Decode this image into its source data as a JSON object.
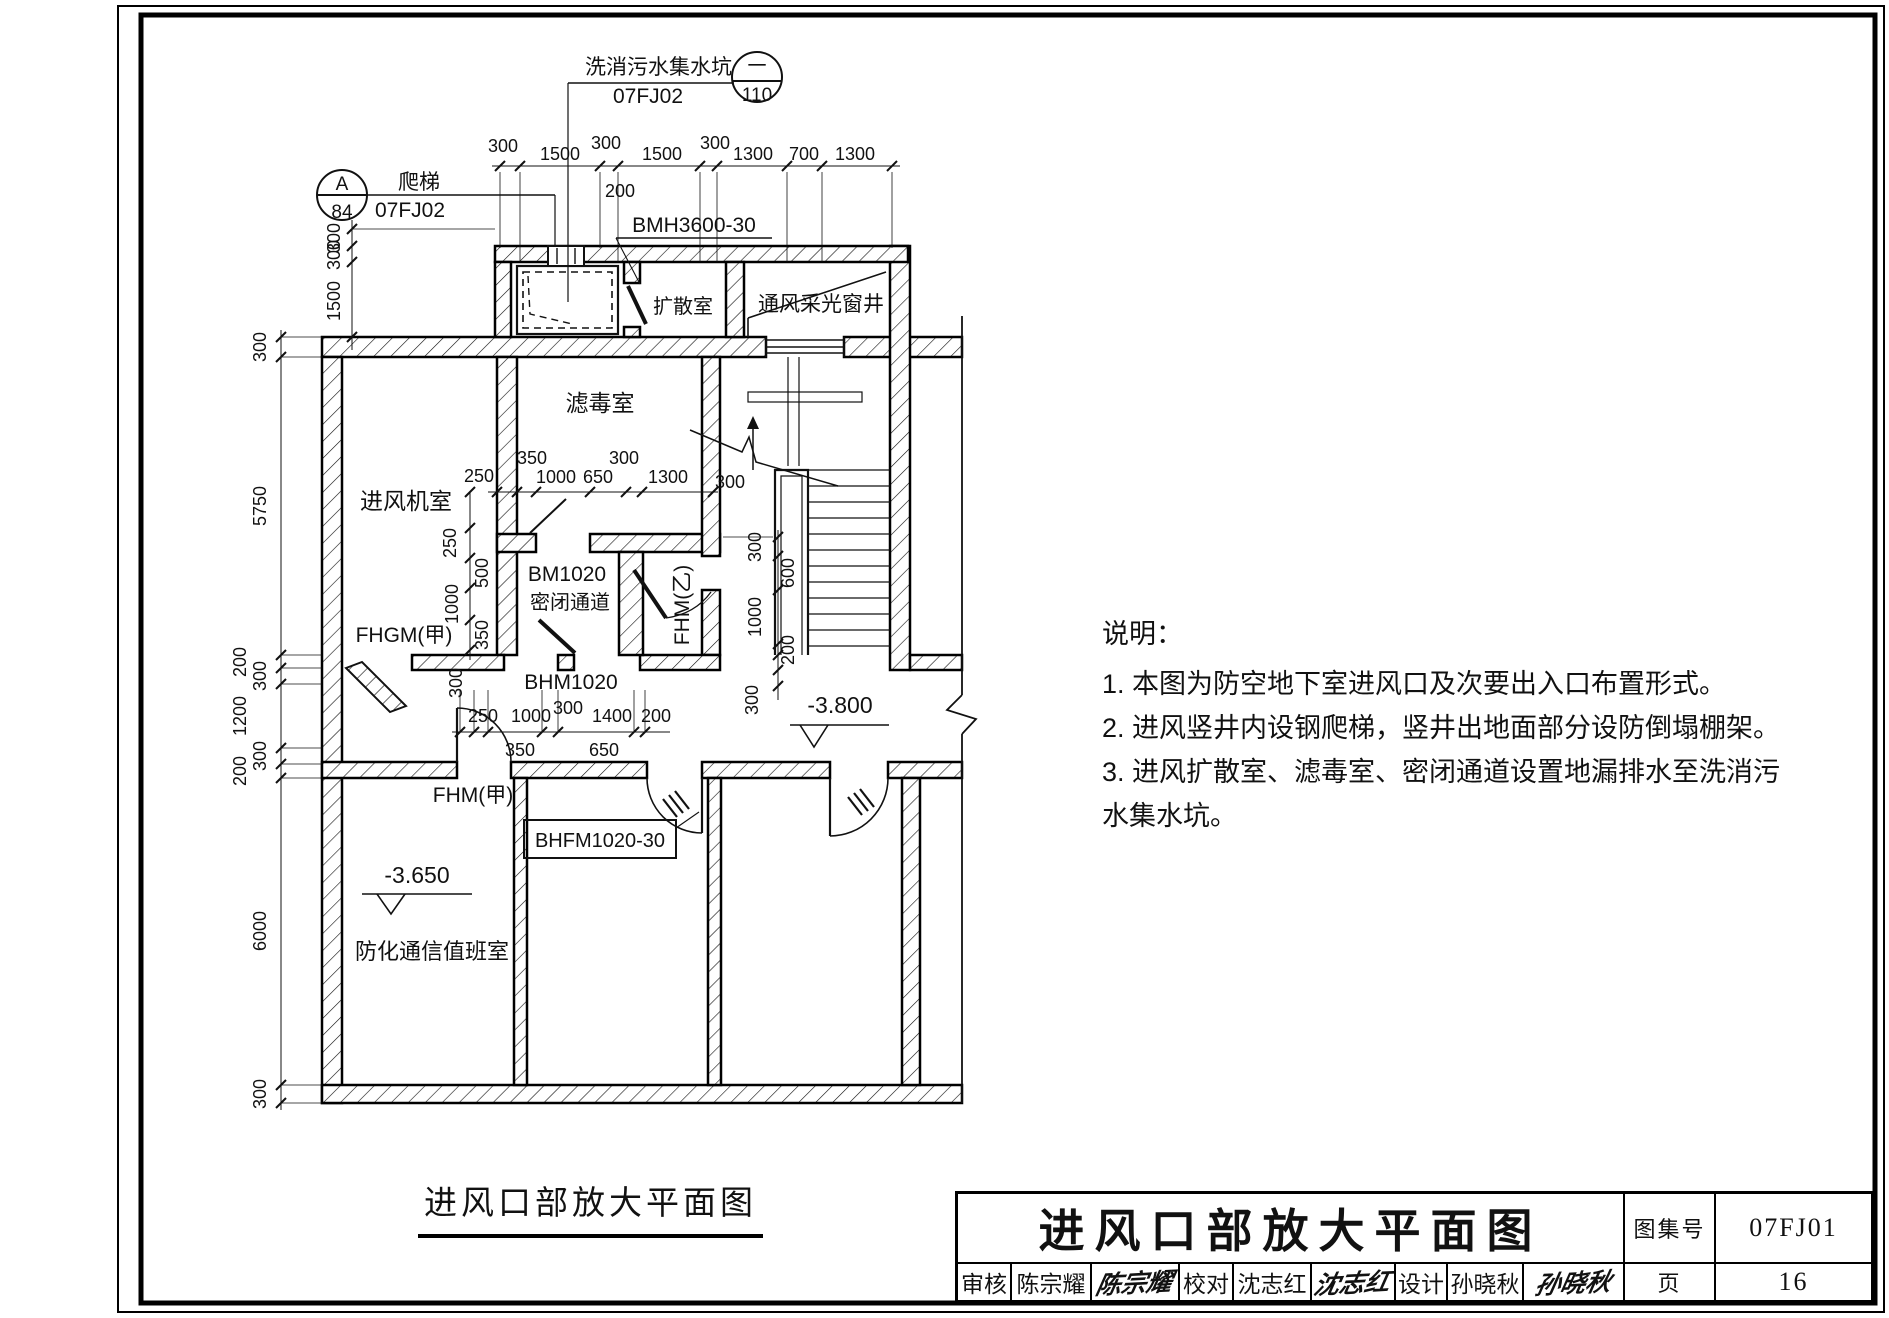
{
  "callouts": {
    "sump": {
      "name": "洗消污水集水坑",
      "ref": "07FJ02",
      "num": "一",
      "den": "110"
    },
    "ladder": {
      "name": "爬梯",
      "ref": "07FJ02",
      "num": "A",
      "den": "84"
    }
  },
  "rooms": {
    "fan_room": "进风机室",
    "filter_room": "滤毒室",
    "diffusion_room": "扩散室",
    "light_well": "通风采光窗井",
    "duty_room": "防化通信值班室",
    "passage": "密闭通道"
  },
  "doors": {
    "bmh": "BMH3600-30",
    "bm": "BM1020",
    "bhm": "BHM1020",
    "fhgm_a": "FHGM(甲)",
    "fhm_b": "FHM(乙)",
    "fhm_a": "FHM(甲)",
    "bhfm": "BHFM1020-30"
  },
  "levels": {
    "corridor": "-3.800",
    "room": "-3.650"
  },
  "dims": {
    "top": [
      "300",
      "1500",
      "300",
      "1500",
      "300",
      "1300",
      "700",
      "1300"
    ],
    "top_sub": "200",
    "shaft_left": [
      "300",
      "300",
      "1500"
    ],
    "left": [
      "300",
      "5750",
      "200",
      "300",
      "1200",
      "300",
      "200",
      "6000",
      "300"
    ],
    "filter": [
      "250",
      "350",
      "1000",
      "650",
      "300",
      "1300"
    ],
    "filter_wall": "300",
    "passage_v": [
      "250",
      "500",
      "1000",
      "350"
    ],
    "passage_wall": "300",
    "stair_v": [
      "300",
      "600",
      "1000",
      "200"
    ],
    "stair_wall": "300",
    "corridor": [
      "250",
      "1000",
      "300",
      "1400",
      "200"
    ],
    "corridor_sub": [
      "350",
      "650"
    ]
  },
  "notes": {
    "heading": "说明：",
    "line1": "1.  本图为防空地下室进风口及次要出入口布置形式。",
    "line2": "2.  进风竖井内设钢爬梯，竖井出地面部分设防倒塌棚架。",
    "line3": "3.  进风扩散室、滤毒室、密闭通道设置地漏排水至洗消污",
    "line4": "水集水坑。"
  },
  "caption": "进风口部放大平面图",
  "titleblock": {
    "title": "进风口部放大平面图",
    "atlas_label": "图集号",
    "atlas_no": "07FJ01",
    "page_label": "页",
    "page_no": "16",
    "review_label": "审核",
    "reviewer": "陈宗耀",
    "reviewer_sig": "陈宗耀",
    "check_label": "校对",
    "checker": "沈志红",
    "checker_sig": "沈志红",
    "design_label": "设计",
    "designer": "孙晓秋",
    "designer_sig": "孙晓秋"
  }
}
